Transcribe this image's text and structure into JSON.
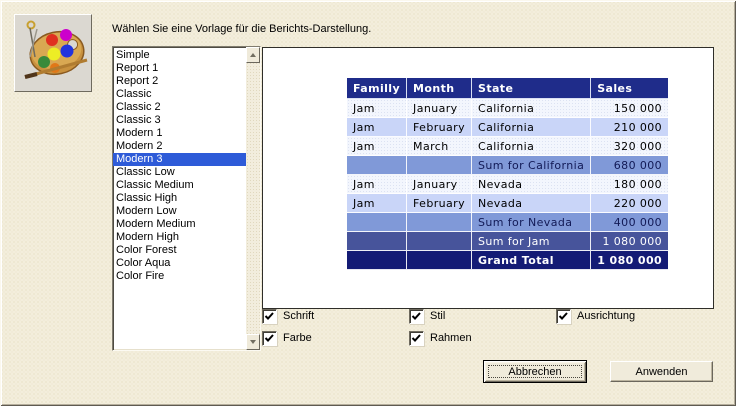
{
  "dialog": {
    "title": "Wählen Sie eine Vorlage für die Berichts-Darstellung.",
    "icon": "palette-icon"
  },
  "colors": {
    "dialog_bg": "#F3EEDC",
    "selection_bg": "#2E5BD8",
    "table_header_bg": "#1F2C8A",
    "row_light_bg": "#F3F6FD",
    "row_alt_bg": "#C9D5F8",
    "row_sum_bg": "#8099D8",
    "row_sumjam_bg": "#47549B",
    "row_grand_bg": "#141B75"
  },
  "template_list": {
    "selected_index": 8,
    "selected": "Modern 3",
    "items": [
      "Simple",
      "Report 1",
      "Report 2",
      "Classic",
      "Classic 2",
      "Classic 3",
      "Modern 1",
      "Modern 2",
      "Modern 3",
      "Classic Low",
      "Classic Medium",
      "Classic High",
      "Modern Low",
      "Modern Medium",
      "Modern High",
      "Color Forest",
      "Color Aqua",
      "Color Fire"
    ]
  },
  "preview_table": {
    "headers": [
      "Familly",
      "Month",
      "State",
      "Sales"
    ],
    "rows": [
      {
        "style": "light",
        "cells": [
          "Jam",
          "January",
          "California",
          "150 000"
        ]
      },
      {
        "style": "alt",
        "cells": [
          "Jam",
          "February",
          "California",
          "210 000"
        ]
      },
      {
        "style": "light",
        "cells": [
          "Jam",
          "March",
          "California",
          "320 000"
        ]
      },
      {
        "style": "sum",
        "cells": [
          "",
          "",
          "Sum for California",
          "680 000"
        ]
      },
      {
        "style": "light",
        "cells": [
          "Jam",
          "January",
          "Nevada",
          "180 000"
        ]
      },
      {
        "style": "alt",
        "cells": [
          "Jam",
          "February",
          "Nevada",
          "220 000"
        ]
      },
      {
        "style": "sum",
        "cells": [
          "",
          "",
          "Sum for Nevada",
          "400 000"
        ]
      },
      {
        "style": "sumjam",
        "cells": [
          "",
          "",
          "Sum for Jam",
          "1 080 000"
        ]
      },
      {
        "style": "grand",
        "cells": [
          "",
          "",
          "Grand Total",
          "1 080 000"
        ]
      }
    ]
  },
  "options": {
    "items": [
      {
        "label": "Schrift",
        "checked": true
      },
      {
        "label": "Stil",
        "checked": true
      },
      {
        "label": "Ausrichtung",
        "checked": true
      },
      {
        "label": "Farbe",
        "checked": true
      },
      {
        "label": "Rahmen",
        "checked": true
      }
    ]
  },
  "buttons": {
    "cancel_label": "Abbrechen",
    "apply_label": "Anwenden"
  }
}
